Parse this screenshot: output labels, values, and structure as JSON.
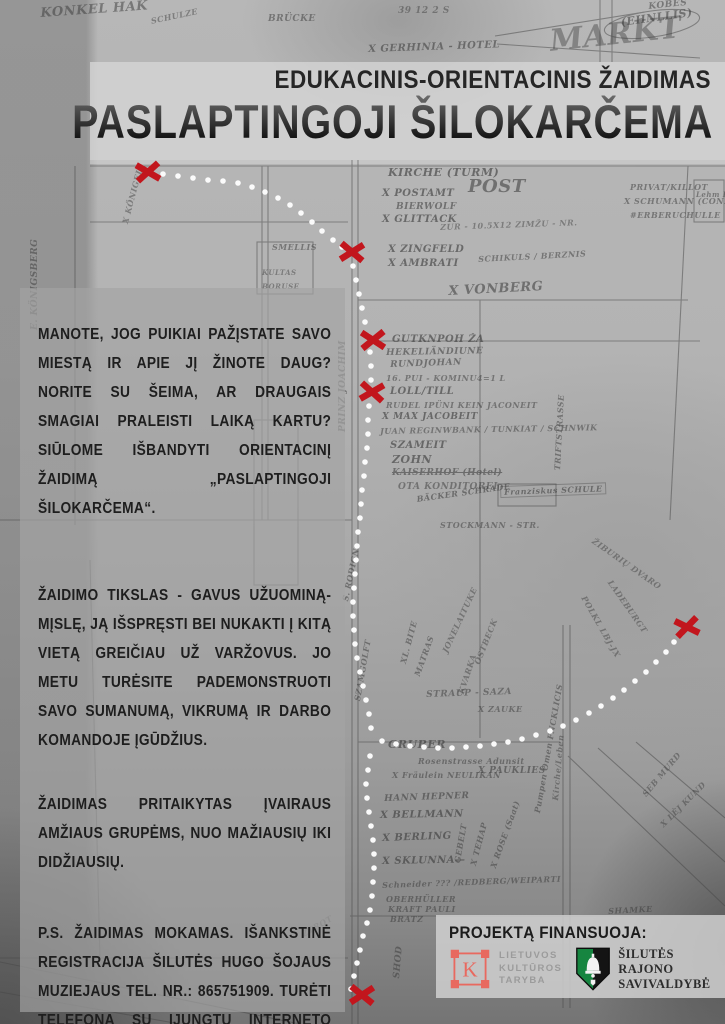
{
  "header": {
    "subtitle": "EDUKACINIS-ORIENTACINIS ŽAIDIMAS",
    "title": "PASLAPTINGOJI ŠILOKARČEMA"
  },
  "body": {
    "paragraphs": [
      "MANOTE, JOG PUIKIAI PAŽĮSTATE SAVO MIESTĄ IR APIE JĮ ŽINOTE DAUG? NORITE SU ŠEIMA, AR DRAUGAIS SMAGIAI PRALEISTI LAIKĄ KARTU? SIŪLOME IŠBANDYTI ORIENTACINĮ ŽAIDIMĄ „PASLAPTINGOJI ŠILOKARČEMA“.",
      "ŽAIDIMO TIKSLAS - GAVUS UŽUOMINĄ-MĮSLĘ, JĄ IŠSPRĘSTI BEI NUKAKTI Į KITĄ VIETĄ GREIČIAU UŽ VARŽOVUS. JO METU TURĖSITE PADEMONSTRUOTI SAVO SUMANUMĄ, VIKRUMĄ IR DARBO KOMANDOJE ĮGŪDŽIUS.",
      "ŽAIDIMAS PRITAIKYTAS ĮVAIRAUS AMŽIAUS GRUPĖMS, NUO MAŽIAUSIŲ IKI DIDŽIAUSIŲ.",
      "P.S. ŽAIDIMAS MOKAMAS. IŠANKSTINĖ REGISTRACIJA ŠILUTĖS HUGO ŠOJAUS MUZIEJAUS TEL. NR.: 865751909. TURĖTI TELEFONĄ SU ĮJUNGTU INTERNETO RYŠIU BEI GPS FUNKCIJA."
    ]
  },
  "funding": {
    "heading": "PROJEKTĄ FINANSUOJA:",
    "culture_council": {
      "letter": "K",
      "lines": [
        "LIETUVOS",
        "KULTŪROS",
        "TARYBA"
      ]
    },
    "municipality": {
      "lines": [
        "ŠILUTĖS",
        "RAJONO",
        "SAVIVALDYBĖ"
      ]
    }
  },
  "colors": {
    "x_red": "#c2161d",
    "dot_white": "#ffffff",
    "ltk_red": "#e8695f",
    "shield_green": "#168540",
    "shield_black": "#141414"
  },
  "route": {
    "x_marks": [
      {
        "x": 148,
        "y": 172,
        "r": -6
      },
      {
        "x": 352,
        "y": 252,
        "r": 4
      },
      {
        "x": 373,
        "y": 340,
        "r": -3
      },
      {
        "x": 372,
        "y": 392,
        "r": 6
      },
      {
        "x": 687,
        "y": 627,
        "r": -10
      },
      {
        "x": 362,
        "y": 995,
        "r": 3
      }
    ],
    "trail_segments": [
      [
        [
          163,
          174
        ],
        [
          178,
          176
        ],
        [
          193,
          178
        ],
        [
          208,
          180
        ],
        [
          223,
          181
        ],
        [
          238,
          183
        ],
        [
          252,
          187
        ],
        [
          265,
          192
        ],
        [
          278,
          198
        ],
        [
          290,
          205
        ],
        [
          301,
          213
        ],
        [
          312,
          222
        ],
        [
          322,
          231
        ],
        [
          333,
          240
        ],
        [
          342,
          247
        ]
      ],
      [
        [
          353,
          266
        ],
        [
          356,
          280
        ],
        [
          359,
          294
        ],
        [
          362,
          308
        ],
        [
          365,
          322
        ],
        [
          368,
          336
        ],
        [
          370,
          352
        ],
        [
          371,
          366
        ],
        [
          371,
          380
        ],
        [
          369,
          406
        ],
        [
          368,
          420
        ],
        [
          368,
          434
        ],
        [
          367,
          448
        ],
        [
          365,
          462
        ],
        [
          364,
          476
        ],
        [
          362,
          490
        ],
        [
          361,
          504
        ],
        [
          360,
          518
        ],
        [
          358,
          532
        ],
        [
          357,
          546
        ],
        [
          356,
          560
        ],
        [
          355,
          574
        ],
        [
          354,
          588
        ],
        [
          353,
          602
        ],
        [
          353,
          616
        ],
        [
          354,
          630
        ],
        [
          355,
          644
        ],
        [
          357,
          658
        ],
        [
          360,
          672
        ],
        [
          363,
          686
        ],
        [
          366,
          700
        ],
        [
          369,
          714
        ],
        [
          371,
          728
        ]
      ],
      [
        [
          382,
          741
        ],
        [
          396,
          744
        ],
        [
          410,
          746
        ],
        [
          424,
          747
        ],
        [
          438,
          748
        ],
        [
          452,
          748
        ],
        [
          466,
          747
        ],
        [
          480,
          746
        ],
        [
          494,
          744
        ],
        [
          508,
          742
        ],
        [
          522,
          739
        ],
        [
          536,
          735
        ],
        [
          550,
          731
        ],
        [
          563,
          726
        ],
        [
          576,
          720
        ],
        [
          589,
          713
        ],
        [
          601,
          706
        ],
        [
          613,
          698
        ],
        [
          624,
          690
        ],
        [
          635,
          681
        ],
        [
          646,
          672
        ],
        [
          656,
          662
        ],
        [
          666,
          652
        ],
        [
          674,
          642
        ],
        [
          681,
          634
        ]
      ],
      [
        [
          370,
          756
        ],
        [
          368,
          770
        ],
        [
          366,
          784
        ],
        [
          367,
          798
        ],
        [
          369,
          812
        ],
        [
          371,
          826
        ],
        [
          373,
          840
        ],
        [
          374,
          854
        ],
        [
          374,
          868
        ],
        [
          373,
          882
        ],
        [
          372,
          896
        ],
        [
          370,
          910
        ],
        [
          367,
          923
        ],
        [
          363,
          936
        ],
        [
          360,
          950
        ],
        [
          357,
          963
        ],
        [
          354,
          976
        ],
        [
          351,
          989
        ]
      ]
    ]
  },
  "map": {
    "labels": [
      {
        "t": "KONKEL HAK",
        "x": 40,
        "y": 6,
        "s": 13,
        "r": -4,
        "o": 0.5
      },
      {
        "t": "SCHULZE",
        "x": 150,
        "y": 16,
        "s": 8,
        "r": -12,
        "o": 0.45
      },
      {
        "t": "BRÜCKE",
        "x": 268,
        "y": 14,
        "s": 9,
        "r": 0,
        "o": 0.5
      },
      {
        "t": "39 12 2 S",
        "x": 398,
        "y": 6,
        "s": 9,
        "r": 0,
        "o": 0.45
      },
      {
        "t": "KOBĖS",
        "x": 648,
        "y": 2,
        "s": 9,
        "r": -6,
        "o": 0.5
      },
      {
        "t": "(EHNLLIS)",
        "x": 620,
        "y": 16,
        "s": 11,
        "r": -8,
        "o": 0.55
      },
      {
        "t": "X GERHINIA - HOTEL",
        "x": 368,
        "y": 44,
        "s": 10,
        "r": -2,
        "o": 0.55
      },
      {
        "t": "MARKT",
        "x": 548,
        "y": 24,
        "s": 30,
        "r": -6,
        "o": 0.4
      },
      {
        "t": "E. KÖNIGSBERG",
        "x": 30,
        "y": 330,
        "s": 9,
        "r": -90,
        "o": 0.5
      },
      {
        "t": "X KÖNIGEL",
        "x": 120,
        "y": 222,
        "s": 8,
        "r": -75,
        "o": 0.45
      },
      {
        "t": "KIRCHE (TURM)",
        "x": 388,
        "y": 166,
        "s": 11,
        "r": 0,
        "o": 0.6
      },
      {
        "t": "X POSTAMT",
        "x": 382,
        "y": 188,
        "s": 10,
        "r": 0,
        "o": 0.6
      },
      {
        "t": "POST",
        "x": 468,
        "y": 176,
        "s": 18,
        "r": 0,
        "o": 0.55
      },
      {
        "t": "BIERWOLF",
        "x": 396,
        "y": 202,
        "s": 9,
        "r": 0,
        "o": 0.55
      },
      {
        "t": "X GLITTACK",
        "x": 382,
        "y": 214,
        "s": 10,
        "r": 0,
        "o": 0.6
      },
      {
        "t": "PRIVAT/KILLOT",
        "x": 630,
        "y": 182,
        "s": 8,
        "r": 0,
        "o": 0.5
      },
      {
        "t": "X SCHUMANN (CONRAD)",
        "x": 624,
        "y": 196,
        "s": 8,
        "r": 0,
        "o": 0.5
      },
      {
        "t": "#ERBERUCHULLE",
        "x": 630,
        "y": 210,
        "s": 8,
        "r": 0,
        "o": 0.5
      },
      {
        "t": "ZUR - 10.5X12 ZIMŽU - NR.",
        "x": 440,
        "y": 222,
        "s": 8,
        "r": -2,
        "o": 0.45
      },
      {
        "t": "Lehm ENTHÜIS",
        "x": 696,
        "y": 190,
        "s": 7,
        "r": 0,
        "o": 0.5
      },
      {
        "t": "SMELLIS",
        "x": 272,
        "y": 242,
        "s": 8,
        "r": 0,
        "o": 0.5
      },
      {
        "t": "X ZINGFELD",
        "x": 388,
        "y": 244,
        "s": 10,
        "r": 0,
        "o": 0.6
      },
      {
        "t": "X AMBRATI",
        "x": 388,
        "y": 258,
        "s": 10,
        "r": 0,
        "o": 0.6
      },
      {
        "t": "SCHIKULS / BERZNIS",
        "x": 478,
        "y": 254,
        "s": 8,
        "r": -3,
        "o": 0.5
      },
      {
        "t": "X VONBERG",
        "x": 448,
        "y": 284,
        "s": 13,
        "r": -3,
        "o": 0.55
      },
      {
        "t": "KULTAS",
        "x": 262,
        "y": 268,
        "s": 7,
        "r": 0,
        "o": 0.45
      },
      {
        "t": "BORUSE",
        "x": 262,
        "y": 282,
        "s": 7,
        "r": 0,
        "o": 0.45
      },
      {
        "t": "PRINZ JOACHIM",
        "x": 338,
        "y": 432,
        "s": 9,
        "r": -90,
        "o": 0.5
      },
      {
        "t": "GUTKNPOH  ŽA",
        "x": 392,
        "y": 334,
        "s": 10,
        "r": 0,
        "o": 0.6
      },
      {
        "t": "HEKELIÄNDIUNE",
        "x": 386,
        "y": 348,
        "s": 9,
        "r": -1,
        "o": 0.55
      },
      {
        "t": "RUNDJOHAN",
        "x": 390,
        "y": 360,
        "s": 9,
        "r": -2,
        "o": 0.55
      },
      {
        "t": "16. PUI - KOMINU4=1 L",
        "x": 386,
        "y": 373,
        "s": 8,
        "r": 0,
        "o": 0.5
      },
      {
        "t": "LOLL/TILL",
        "x": 390,
        "y": 386,
        "s": 10,
        "r": 0,
        "o": 0.6
      },
      {
        "t": "RUDEL IPÜNI KEIN JACONEIT",
        "x": 386,
        "y": 400,
        "s": 8,
        "r": 0,
        "o": 0.5
      },
      {
        "t": "X MAX JACOBEIT",
        "x": 382,
        "y": 412,
        "s": 9,
        "r": 0,
        "o": 0.6
      },
      {
        "t": "JUAN REGINWBANK / TUNKIAT / SCHNWIK",
        "x": 380,
        "y": 426,
        "s": 8,
        "r": -1,
        "o": 0.5
      },
      {
        "t": "SZAMEIT",
        "x": 390,
        "y": 440,
        "s": 10,
        "r": 0,
        "o": 0.6
      },
      {
        "t": "ZOHN",
        "x": 392,
        "y": 453,
        "s": 11,
        "r": 0,
        "o": 0.6
      },
      {
        "t": "KAISERHOF (Hotel)",
        "x": 392,
        "y": 468,
        "s": 9,
        "r": 0,
        "o": 0.55,
        "strike": true
      },
      {
        "t": "OTA KONDITOREI",
        "x": 398,
        "y": 482,
        "s": 9,
        "r": 0,
        "o": 0.5
      },
      {
        "t": "BÄCKER SCHRADE",
        "x": 416,
        "y": 494,
        "s": 8,
        "r": -8,
        "o": 0.55
      },
      {
        "t": "Franziskus SCHULE",
        "x": 500,
        "y": 486,
        "s": 8,
        "r": -2,
        "o": 0.55,
        "box": true
      },
      {
        "t": "STOCKMANN - STR.",
        "x": 440,
        "y": 520,
        "s": 8,
        "r": 0,
        "o": 0.5
      },
      {
        "t": "TRIFTSTRASSE",
        "x": 552,
        "y": 470,
        "s": 8,
        "r": -87,
        "o": 0.5
      },
      {
        "t": "S. RODIGN",
        "x": 340,
        "y": 600,
        "s": 8,
        "r": -78,
        "o": 0.5
      },
      {
        "t": "ŽIBURIŲ DVARO",
        "x": 596,
        "y": 536,
        "s": 8,
        "r": 35,
        "o": 0.45
      },
      {
        "t": "LADEBURGT",
        "x": 614,
        "y": 578,
        "s": 8,
        "r": 55,
        "o": 0.45
      },
      {
        "t": "POLKL LBJ-JX",
        "x": 588,
        "y": 594,
        "s": 8,
        "r": 60,
        "o": 0.45
      },
      {
        "t": "SZAMGOLFT",
        "x": 352,
        "y": 700,
        "s": 8,
        "r": -80,
        "o": 0.5
      },
      {
        "t": "XL. BITE",
        "x": 398,
        "y": 662,
        "s": 8,
        "r": -75,
        "o": 0.5
      },
      {
        "t": "MATRAS",
        "x": 412,
        "y": 674,
        "s": 8,
        "r": -70,
        "o": 0.5
      },
      {
        "t": "JONELAITUKE",
        "x": 440,
        "y": 650,
        "s": 8,
        "r": -65,
        "o": 0.45
      },
      {
        "t": "KVARKA",
        "x": 456,
        "y": 692,
        "s": 8,
        "r": -72,
        "o": 0.45
      },
      {
        "t": "OSTBECK",
        "x": 472,
        "y": 662,
        "s": 8,
        "r": -68,
        "o": 0.45
      },
      {
        "t": "STRAUP - SAZA",
        "x": 426,
        "y": 690,
        "s": 9,
        "r": -2,
        "o": 0.5
      },
      {
        "t": "X ZAUKE",
        "x": 478,
        "y": 704,
        "s": 8,
        "r": 0,
        "o": 0.5
      },
      {
        "t": "GRUBER",
        "x": 388,
        "y": 738,
        "s": 11,
        "r": 0,
        "o": 0.6
      },
      {
        "t": "Rosenstrasse Adunsit",
        "x": 418,
        "y": 756,
        "s": 8,
        "r": 0,
        "o": 0.5
      },
      {
        "t": "X Fräulein NEULIKAN",
        "x": 392,
        "y": 770,
        "s": 8,
        "r": 0,
        "o": 0.5
      },
      {
        "t": "X PAUKLIES",
        "x": 478,
        "y": 766,
        "s": 9,
        "r": 0,
        "o": 0.55
      },
      {
        "t": "Pumpen Omen FNCKLICIS",
        "x": 532,
        "y": 812,
        "s": 8,
        "r": -80,
        "o": 0.5
      },
      {
        "t": "Kirche/Leben",
        "x": 550,
        "y": 800,
        "s": 8,
        "r": -85,
        "o": 0.45
      },
      {
        "t": "HANN HEPNER",
        "x": 384,
        "y": 794,
        "s": 9,
        "r": -2,
        "o": 0.55
      },
      {
        "t": "X BELLMANN",
        "x": 380,
        "y": 810,
        "s": 10,
        "r": -1,
        "o": 0.6
      },
      {
        "t": "X BERLING",
        "x": 382,
        "y": 833,
        "s": 10,
        "r": -2,
        "o": 0.6
      },
      {
        "t": "X SKLUNNA—",
        "x": 382,
        "y": 856,
        "s": 10,
        "r": -1,
        "o": 0.6
      },
      {
        "t": "Schneider ??? /REDBERG/WEIPARTI",
        "x": 382,
        "y": 880,
        "s": 8,
        "r": -2,
        "o": 0.5
      },
      {
        "t": "OBERHÜLLER",
        "x": 386,
        "y": 894,
        "s": 8,
        "r": 0,
        "o": 0.5
      },
      {
        "t": "KRAFT PAULI",
        "x": 388,
        "y": 904,
        "s": 8,
        "r": 0,
        "o": 0.5
      },
      {
        "t": "BRATZ",
        "x": 390,
        "y": 914,
        "s": 8,
        "r": 0,
        "o": 0.5
      },
      {
        "t": "GEBELT",
        "x": 452,
        "y": 862,
        "s": 8,
        "r": -80,
        "o": 0.5
      },
      {
        "t": "X TEHAP",
        "x": 468,
        "y": 864,
        "s": 8,
        "r": -75,
        "o": 0.5
      },
      {
        "t": "X ROSE (Saat)",
        "x": 488,
        "y": 866,
        "s": 8,
        "r": -70,
        "o": 0.5
      },
      {
        "t": "SEB MURD",
        "x": 640,
        "y": 792,
        "s": 8,
        "r": -50,
        "o": 0.45
      },
      {
        "t": "X LĖJ KUND",
        "x": 658,
        "y": 822,
        "s": 8,
        "r": -45,
        "o": 0.45
      },
      {
        "t": "SHAMKE",
        "x": 608,
        "y": 906,
        "s": 8,
        "r": -3,
        "o": 0.5
      },
      {
        "t": "SHOD",
        "x": 392,
        "y": 978,
        "s": 9,
        "r": -85,
        "o": 0.5
      },
      {
        "t": "ZTROT",
        "x": 300,
        "y": 930,
        "s": 8,
        "r": -30,
        "o": 0.45
      }
    ]
  }
}
